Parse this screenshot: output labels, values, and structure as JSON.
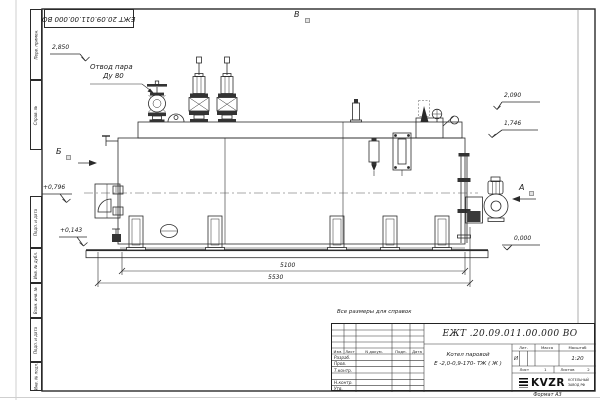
{
  "sheet": {
    "stamp_number": "ЕЖТ 20.09.011.00.000  ВО",
    "note": "Все размеры для справок",
    "format_label": "Формат А3",
    "margin_columns": [
      "Перв. примен.",
      "Справ. №",
      "Подп. и дата",
      "Инв. № дубл.",
      "Взам. инв. №",
      "Подп. и дата",
      "Инв. № подл."
    ]
  },
  "views": {
    "top": "В",
    "left": "Б",
    "right": "А"
  },
  "callouts": {
    "steam_line1": "Отвод пара",
    "steam_line2": "Ду 80"
  },
  "levels": {
    "l1": "2,850",
    "l2": "2,090",
    "l3": "1,746",
    "l4": "+0,796",
    "l5": "+0,143",
    "l6": "0,000"
  },
  "dimensions": {
    "inner_length": "5100",
    "total_length": "5530"
  },
  "titleblock": {
    "doc_number": "ЕЖТ .20.09.011.00.000  ВО",
    "product_name_line1": "Котел паровой",
    "product_name_line2": "Е -2,0-0,9-170- ТЖ ( Ж )",
    "cols": {
      "izm": "Изм.",
      "list": "Лист",
      "ndoc": "N докум.",
      "podp": "Подп.",
      "data": "Дата"
    },
    "rows": {
      "r1": "Разраб.",
      "r2": "Пров.",
      "r3": "Т.контр.",
      "r4": "Н.контр.",
      "r5": "Утв."
    },
    "lit_label": "Лит.",
    "lit_value": "И",
    "massa_label": "Масса",
    "masshtab_label": "Масштаб",
    "scale_value": "1:20",
    "sheet_label": "Лист",
    "sheet_num": "1",
    "sheets_label": "Листов",
    "sheets_num": "2",
    "logo_text": "KVZR",
    "logo_sub1": "КОТЕЛЬНЫЙ",
    "logo_sub2": "ЗАВОД РФ"
  }
}
